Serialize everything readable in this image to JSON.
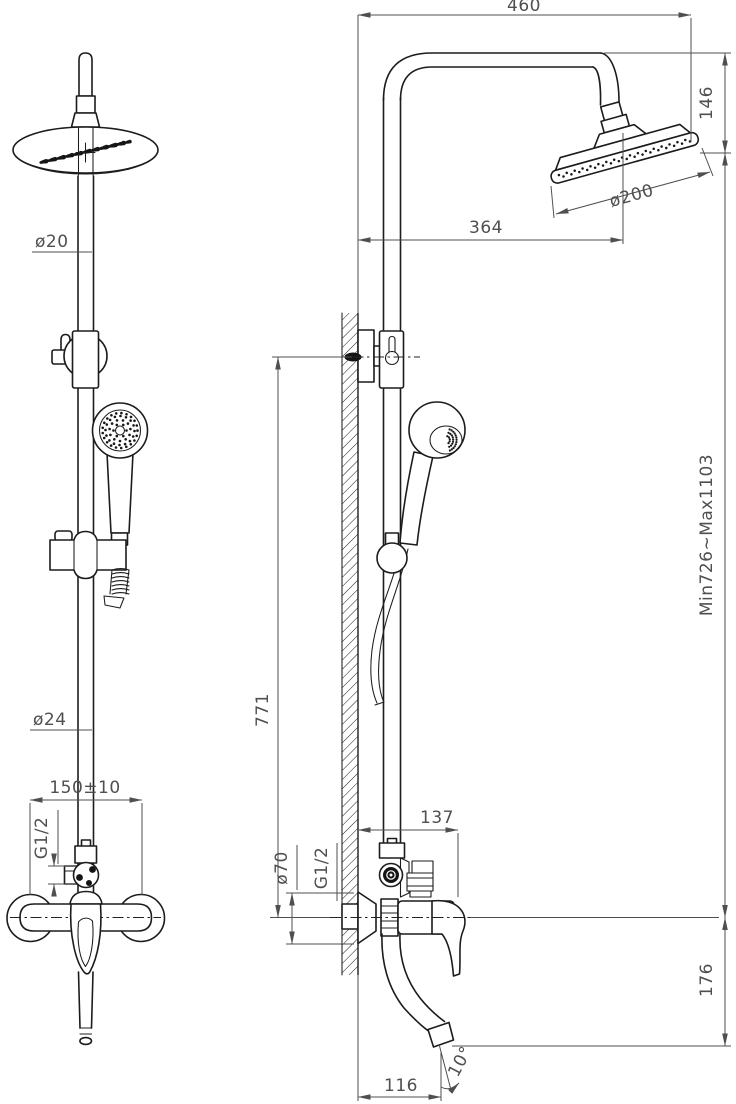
{
  "colors": {
    "background": "#ffffff",
    "outline": "#1c1c1c",
    "dimension": "#4f4f4f"
  },
  "drawing": {
    "kind": "technical dimension drawing",
    "subject": "wall-mounted shower column with overhead shower, hand shower and mixer spout",
    "views": [
      "front view",
      "side view"
    ]
  },
  "dims": {
    "top_width": "460",
    "head_drop": "146",
    "head_diameter": "ø200",
    "head_offset_from_wall": "364",
    "upper_pipe_diameter": "ø20",
    "lower_pipe_diameter": "ø24",
    "inlet_spacing": "150±10",
    "front_inlet_thread": "G1/2",
    "bracket_to_mixer_height": "771",
    "escutcheon_diameter": "ø70",
    "side_inlet_thread": "G1/2",
    "mixer_projection": "137",
    "column_height_range": "Min726~Max1103",
    "spout_drop": "176",
    "spout_reach": "116",
    "spout_angle": "10°"
  }
}
